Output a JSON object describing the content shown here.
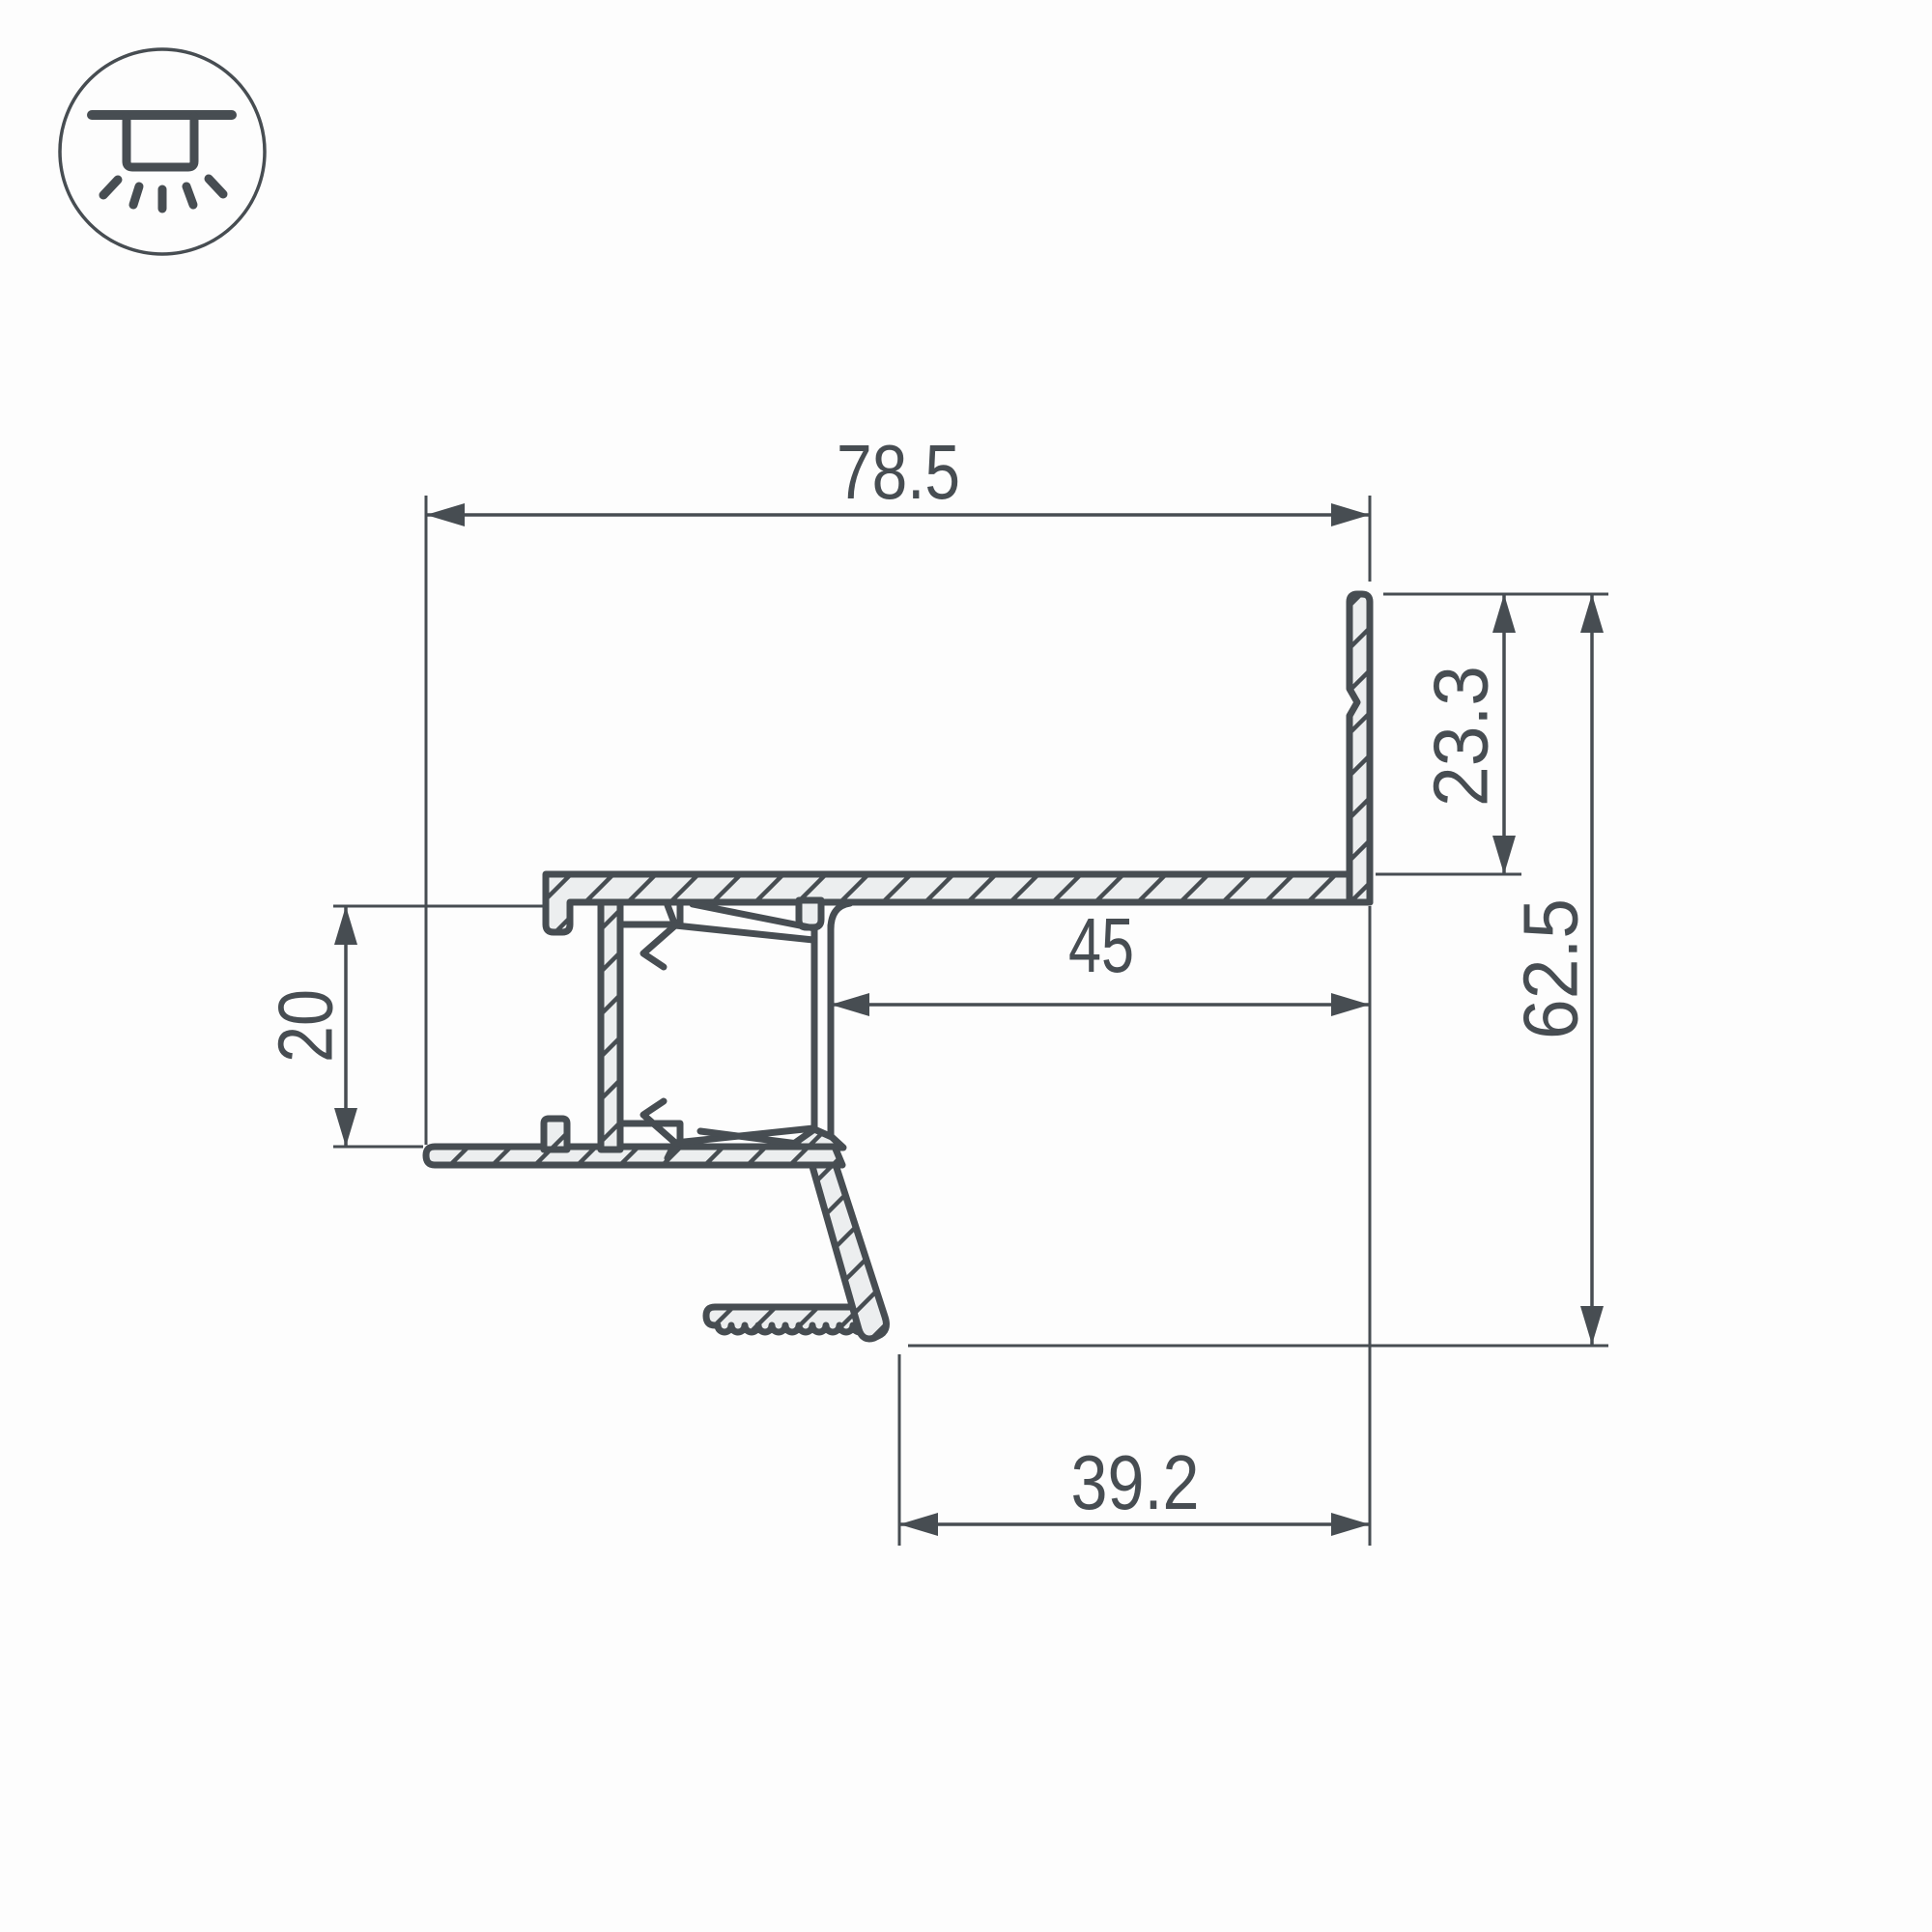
{
  "icon": {
    "name": "recessed-downlight-icon"
  },
  "drawing": {
    "type": "led-profile-cross-section",
    "dimensions": {
      "overall_width": "78.5",
      "inner_width": "45",
      "bottom_offset": "39.2",
      "slot_height": "20",
      "flange_drop": "23.3",
      "overall_height": "62.5"
    },
    "colors": {
      "line": "#474D52",
      "profile_fill": "#ECEEEF",
      "background": "#FDFDFD"
    }
  }
}
